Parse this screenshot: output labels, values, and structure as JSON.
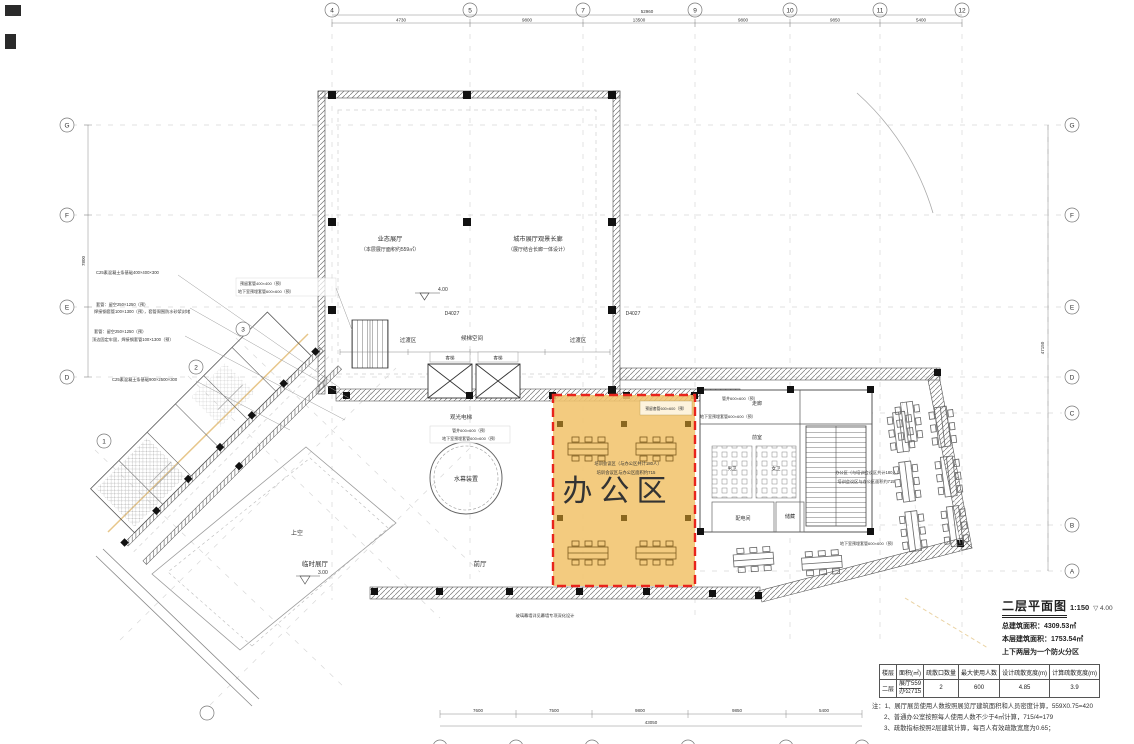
{
  "highlight": {
    "label": "办公区",
    "note1": "培训会议区（与办公区共计180人）",
    "note2": "培训会议区与办公区面积约715",
    "fill": "#f1c36c",
    "border": "#e8241c"
  },
  "rooms": {
    "exhibition_hall": "业态展厅",
    "exhibition_hall_sub": "（本层展厅面积约559㎡）",
    "gallery": "城市展厅观景长廊",
    "gallery_sub": "（展厅结合长廊一体设计）",
    "transition_left": "过渡区",
    "elevator_lobby": "候梯空间",
    "transition_right": "过渡区",
    "sightseeing_elevator": "观光电梯",
    "water_curtain": "水幕装置",
    "void": "上空",
    "temp_exhibition": "临时展厅",
    "front_hall": "前厅",
    "corridor": "走廊",
    "front_room": "前室",
    "male_wc": "男卫",
    "female_wc": "女卫",
    "power_room": "配电间",
    "storage": "储藏",
    "lift_left": "客梯",
    "lift_right": "客梯",
    "office_right_note_1": "办公区（与培训会议区共计180人）",
    "office_right_note_2": "培训会议区与办公区面积约715"
  },
  "door_tags": {
    "left": "D4027",
    "right": "D4027"
  },
  "elevations": {
    "main": "4.00",
    "temp": "3.00",
    "title": "4.00"
  },
  "grid": {
    "left": [
      "G",
      "F",
      "E",
      "D"
    ],
    "right": [
      "G",
      "F",
      "E",
      "D",
      "C",
      "B",
      "A"
    ],
    "top": [
      "4",
      "5",
      "7",
      "9",
      "10",
      "11",
      "12"
    ],
    "diagonal": [
      "1",
      "2",
      "3"
    ]
  },
  "dimensions": {
    "top_total": "52960",
    "top_segments": [
      "4730",
      "9800",
      "13500",
      "9800",
      "9850",
      "5400"
    ],
    "bottom_total": "43050",
    "bottom_segments": [
      "7600",
      "7500",
      "9800",
      "9850",
      "5400"
    ],
    "left_side": "7800",
    "right_side": "47150"
  },
  "annotations": {
    "left": [
      "C25素混凝土条基础400×400×300",
      "套管：留空250×1250（预）",
      "焊接钢套管100×1300（预），套管周围防水砂浆封堵",
      "套管：留空250×1250（预）",
      "顶边固定牢固，焊接钢套管100×1300（预）",
      "C25素混凝土条基础900×2500×300"
    ],
    "block": [
      "预留套管400×400（预）",
      "地下室预埋套管600×600（预）"
    ],
    "center": [
      "管井600×600（预）",
      "地下室预埋套管600×600（预）"
    ],
    "highlight_top": "预留套管600×600（预）",
    "right_top": [
      "管井600×600（预）",
      "地下室预埋套管600×600（预）"
    ],
    "right_mid": "地下室预埋套管600×600（预）",
    "bottom": "玻璃幕墙详见幕墙专项深化设计"
  },
  "title_block": {
    "title": "二层平面图",
    "scale": "1:150",
    "line1": "总建筑面积：4309.53㎡",
    "line2": "本层建筑面积：1753.54㎡",
    "line3": "上下两层为一个防火分区"
  },
  "table": {
    "headers": [
      "楼层",
      "面积(㎡)",
      "疏散口数量",
      "最大使用人数",
      "设计疏散宽度(m)",
      "计算疏散宽度(m)"
    ],
    "row": {
      "floor": "二层",
      "area_top": "展厅559",
      "area_bottom": "办公715",
      "exits": "2",
      "people": "600",
      "design_width": "4.85",
      "calc_width": "3.9"
    }
  },
  "notes": [
    "注：1、展厅展览使用人数按照展览厅建筑面积和人员密度计算，559X0.75=420",
    "2、普通办公室按照每人使用人数不少于4㎡计算，715/4=179",
    "3、疏散指标按照2层建筑计算，每百人有效疏散宽度为0.65；"
  ]
}
